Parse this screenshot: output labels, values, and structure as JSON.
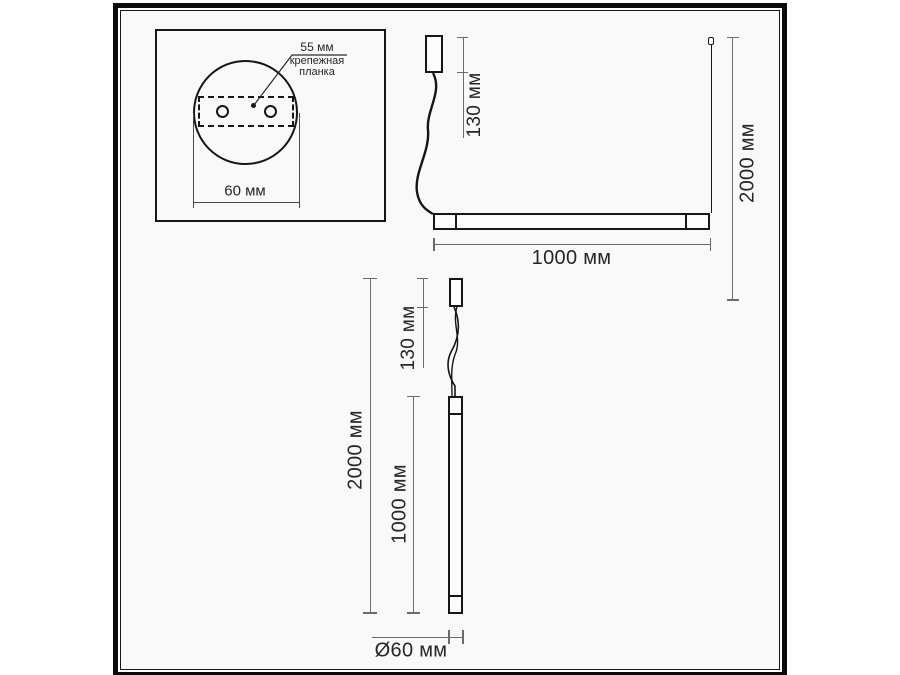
{
  "colors": {
    "outline": "#161616",
    "dim": "#6b6b6b",
    "text": "#262626",
    "canvas": "#f9f9f9",
    "page": "#ffffff"
  },
  "detail_view": {
    "hole_spacing": "55 мм",
    "mount_plate_line1": "крепежная",
    "mount_plate_line2": "планка",
    "base_width": "60 мм"
  },
  "horizontal_view": {
    "canopy_drop": "130 мм",
    "max_suspension": "2000 мм",
    "fixture_length": "1000 мм"
  },
  "vertical_view": {
    "canopy_drop": "130 мм",
    "max_suspension": "2000 мм",
    "fixture_length": "1000 мм",
    "diameter": "Ø60 мм"
  }
}
